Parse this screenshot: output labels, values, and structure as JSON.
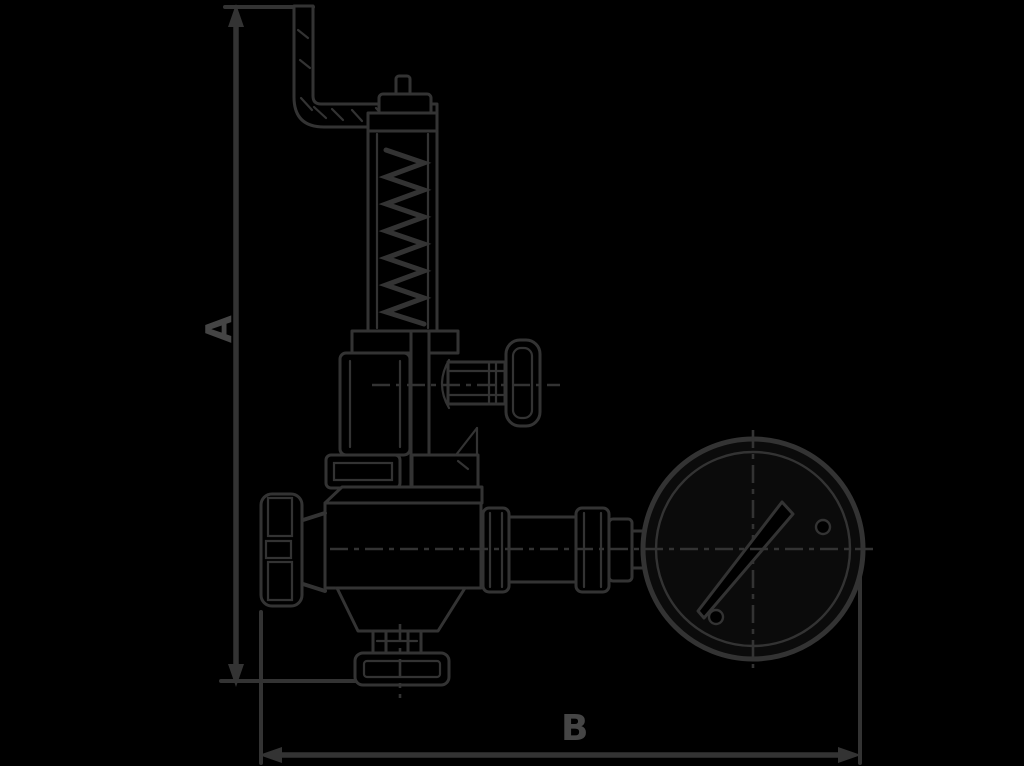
{
  "canvas": {
    "width": 1024,
    "height": 766,
    "background_color": "#000000"
  },
  "diagram": {
    "type": "technical-line-drawing",
    "subject_visible": "angle safety valve with lift lever, spring housing, handwheel, outlet flange and pressure gauge",
    "line_color": "#333333",
    "label_color": "#454545",
    "gauge_face_color": "#0b0b0b",
    "labels": {
      "height_dimension": "A",
      "width_dimension": "B"
    },
    "components": [
      "lift-lever",
      "spring-housing-cap",
      "spring-housing-tube",
      "spring-coil",
      "collar",
      "bonnet",
      "test-outlet",
      "test-knob",
      "union-nut",
      "handwheel",
      "valve-body",
      "tailpiece",
      "outlet-flange",
      "pipe-union",
      "pipe-nipple",
      "gauge-adapter",
      "pressure-gauge",
      "gauge-needle",
      "dimension-line-a",
      "dimension-line-b"
    ]
  }
}
